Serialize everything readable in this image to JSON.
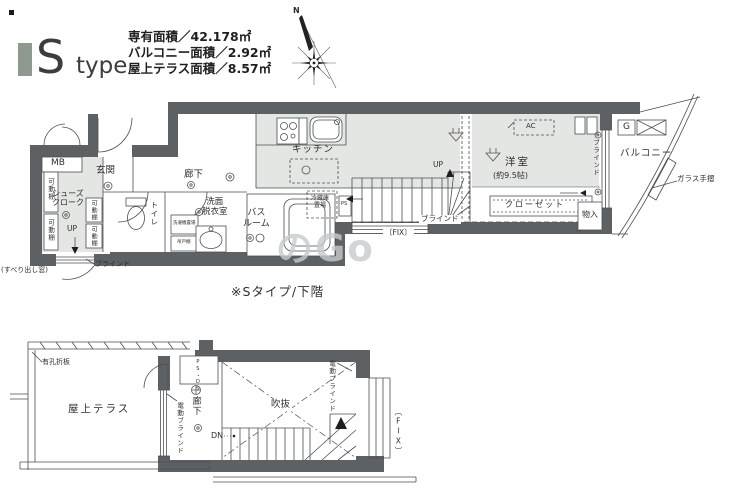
{
  "colors": {
    "wall": "#5d6164",
    "room_fill": "#e4e6e3",
    "logo_bar": "#8e998f",
    "line": "#4b4f53"
  },
  "header": {
    "logo_s": "S",
    "logo_type": "type",
    "area_lines": "専有面積／42.178㎡\nバルコニー面積／2.92㎡\n屋上テラス面積／8.57㎡",
    "compass_north": "N"
  },
  "upper_plan": {
    "caption": "※Sタイプ/下階",
    "mb": "MB",
    "genkan": "玄関",
    "shoes_closet": "シューズ\nクローク",
    "shelf": "可動棚",
    "up": "UP",
    "blind": "ブラインド",
    "sliding_window": "(すべり出し窓)",
    "toilet": "トイレ",
    "hallway": "廊下",
    "washroom": "洗面\n脱衣室",
    "washer": "洗濯機置場",
    "cupboard": "吊戸棚",
    "bathroom": "バス\nルーム",
    "kitchen": "キッチン",
    "fridge": "冷蔵庫\n置場",
    "ps": "PS",
    "room": "洋室",
    "room_size": "(約9.5帖)",
    "ac": "AC",
    "closet": "クローゼット",
    "fix": "〔FIX〕",
    "mono_ire": "物入",
    "g_meter": "G",
    "balcony": "バルコニー",
    "glass_rail": "ガラス手摺"
  },
  "lower_plan": {
    "perforated_plate": "有孔折板",
    "roof_terrace": "屋上テラス",
    "ps_ds": "PS・DS",
    "hallway": "廊下",
    "electric_blind": "電動ブラインド",
    "void": "吹抜",
    "dn": "DN",
    "fix": "〔FIX〕"
  },
  "watermark": "のGo"
}
